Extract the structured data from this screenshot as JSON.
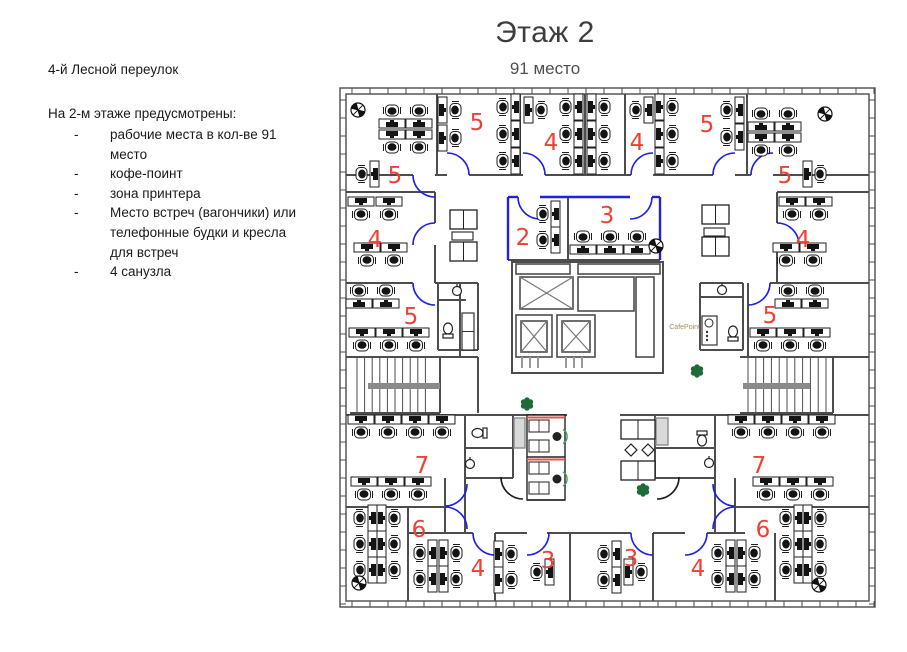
{
  "title": "Этаж 2",
  "subtitle": "91 место",
  "sidebar": {
    "address": "4-й Лесной переулок",
    "intro": "На 2-м этаже предусмотрены:",
    "bullets": [
      "рабочие места в кол-ве 91 место",
      "кофе-поинт",
      "зона принтера",
      "Место встреч (вагончики) или телефонные будки и кресла для встреч",
      "4 санузла"
    ]
  },
  "plan": {
    "colors": {
      "wall": "#4d4d4d",
      "door_blue": "#1f1fe8",
      "door_black": "#1a1a1a",
      "room_number": "#ee4035",
      "plant": "#1e6b38",
      "booth_red": "#e0584c",
      "booth_green": "#3fa45f",
      "gray_fill": "#d9d9d9",
      "landing": "#8a8a8a",
      "cafepoint_text": "#a38e55",
      "desk_stroke": "#1f1f1f",
      "desk_dark": "#141414"
    },
    "cafepoint_label": "CafePoint",
    "cafe": {
      "counter": [
        702,
        316,
        15,
        29
      ],
      "label_pos": [
        700,
        329
      ]
    },
    "envelope": [
      [
        340,
        88,
        535,
        519
      ],
      [
        346,
        94,
        523,
        507
      ]
    ],
    "mullion_spacing": 18,
    "room_numbers": [
      [
        "5",
        477,
        122
      ],
      [
        "4",
        551,
        142
      ],
      [
        "4",
        637,
        142
      ],
      [
        "5",
        707,
        124
      ],
      [
        "5",
        395,
        175
      ],
      [
        "5",
        785,
        175
      ],
      [
        "4",
        375,
        239
      ],
      [
        "4",
        803,
        239
      ],
      [
        "2",
        523,
        237
      ],
      [
        "3",
        607,
        215
      ],
      [
        "5",
        411,
        316
      ],
      [
        "5",
        770,
        315
      ],
      [
        "7",
        422,
        465
      ],
      [
        "7",
        759,
        465
      ],
      [
        "6",
        419,
        529
      ],
      [
        "6",
        763,
        529
      ],
      [
        "4",
        478,
        568
      ],
      [
        "3",
        548,
        560
      ],
      [
        "3",
        631,
        558
      ],
      [
        "4",
        698,
        568
      ]
    ],
    "walls": [
      [
        437,
        94,
        437,
        175
      ],
      [
        520,
        94,
        520,
        175
      ],
      [
        585,
        94,
        585,
        175
      ],
      [
        625,
        94,
        625,
        175
      ],
      [
        657,
        94,
        657,
        175
      ],
      [
        747,
        94,
        747,
        175
      ],
      [
        346,
        175,
        413,
        175
      ],
      [
        435,
        175,
        447,
        175
      ],
      [
        469,
        175,
        523,
        175
      ],
      [
        545,
        175,
        631,
        175
      ],
      [
        653,
        175,
        713,
        175
      ],
      [
        735,
        175,
        751,
        175
      ],
      [
        773,
        175,
        869,
        175
      ],
      [
        346,
        192,
        435,
        192
      ],
      [
        777,
        192,
        869,
        192
      ],
      [
        435,
        192,
        435,
        223
      ],
      [
        435,
        245,
        435,
        283
      ],
      [
        777,
        192,
        777,
        223
      ],
      [
        777,
        245,
        777,
        283
      ],
      [
        346,
        283,
        413,
        283
      ],
      [
        435,
        283,
        460,
        283
      ],
      [
        770,
        283,
        869,
        283
      ],
      [
        460,
        283,
        460,
        357
      ],
      [
        748,
        283,
        748,
        357
      ],
      [
        346,
        357,
        478,
        357
      ],
      [
        740,
        357,
        869,
        357
      ],
      [
        440,
        357,
        440,
        413
      ],
      [
        478,
        357,
        478,
        413
      ],
      [
        350,
        413,
        440,
        413
      ],
      [
        740,
        413,
        833,
        413
      ],
      [
        833,
        357,
        833,
        413
      ],
      [
        346,
        415,
        567,
        415
      ],
      [
        620,
        415,
        869,
        415
      ],
      [
        465,
        415,
        465,
        478
      ],
      [
        513,
        415,
        513,
        478
      ],
      [
        465,
        478,
        513,
        478
      ],
      [
        465,
        448,
        513,
        448
      ],
      [
        655,
        415,
        655,
        478
      ],
      [
        715,
        415,
        715,
        478
      ],
      [
        655,
        478,
        715,
        478
      ],
      [
        655,
        448,
        715,
        448
      ],
      [
        445,
        478,
        445,
        533
      ],
      [
        465,
        478,
        465,
        533
      ],
      [
        715,
        478,
        715,
        533
      ],
      [
        735,
        478,
        735,
        533
      ],
      [
        346,
        507,
        445,
        507
      ],
      [
        735,
        507,
        869,
        507
      ],
      [
        408,
        507,
        408,
        601
      ],
      [
        408,
        533,
        473,
        533
      ],
      [
        495,
        533,
        527,
        533
      ],
      [
        547,
        533,
        631,
        533
      ],
      [
        653,
        533,
        685,
        533
      ],
      [
        707,
        533,
        745,
        533
      ],
      [
        495,
        533,
        495,
        601
      ],
      [
        570,
        533,
        570,
        601
      ],
      [
        653,
        533,
        653,
        601
      ],
      [
        775,
        533,
        775,
        601
      ],
      [
        508,
        260,
        660,
        260
      ],
      [
        568,
        197,
        568,
        260
      ],
      [
        438,
        283,
        478,
        283
      ],
      [
        438,
        283,
        438,
        350
      ],
      [
        478,
        283,
        478,
        350
      ],
      [
        438,
        350,
        478,
        350
      ],
      [
        438,
        300,
        466,
        300
      ],
      [
        700,
        283,
        743,
        283
      ],
      [
        700,
        283,
        700,
        350
      ],
      [
        743,
        283,
        743,
        350
      ],
      [
        700,
        350,
        743,
        350
      ],
      [
        700,
        297,
        743,
        297
      ]
    ],
    "blue_walls": [
      [
        508,
        197,
        508,
        260
      ],
      [
        660,
        197,
        660,
        260
      ],
      [
        508,
        197,
        518,
        197
      ],
      [
        540,
        197,
        630,
        197
      ],
      [
        652,
        197,
        660,
        197
      ]
    ],
    "doors": [
      [
        447,
        175,
        270,
        360,
        "b"
      ],
      [
        523,
        175,
        270,
        360,
        "b"
      ],
      [
        653,
        175,
        270,
        180,
        "b"
      ],
      [
        735,
        175,
        270,
        180,
        "b"
      ],
      [
        435,
        175,
        90,
        180,
        "b"
      ],
      [
        773,
        175,
        270,
        180,
        "b"
      ],
      [
        435,
        245,
        270,
        180,
        "b"
      ],
      [
        777,
        245,
        270,
        360,
        "b"
      ],
      [
        435,
        283,
        90,
        180,
        "b"
      ],
      [
        748,
        283,
        90,
        0,
        "b"
      ],
      [
        540,
        197,
        90,
        180,
        "b"
      ],
      [
        630,
        197,
        90,
        0,
        "b"
      ],
      [
        445,
        484,
        0,
        90,
        "b"
      ],
      [
        445,
        529,
        270,
        360,
        "b"
      ],
      [
        735,
        484,
        90,
        180,
        "b"
      ],
      [
        735,
        529,
        180,
        270,
        "b"
      ],
      [
        495,
        533,
        90,
        180,
        "b"
      ],
      [
        527,
        533,
        0,
        90,
        "b"
      ],
      [
        653,
        533,
        90,
        180,
        "b"
      ],
      [
        685,
        533,
        0,
        90,
        "b"
      ],
      [
        523,
        477,
        90,
        180,
        "k"
      ],
      [
        657,
        477,
        0,
        90,
        "k"
      ]
    ],
    "desks": [
      [
        392,
        115,
        180
      ],
      [
        419,
        115,
        180
      ],
      [
        392,
        143,
        0
      ],
      [
        419,
        143,
        0
      ],
      [
        366,
        174,
        90
      ],
      [
        451,
        110,
        270
      ],
      [
        451,
        138,
        270
      ],
      [
        507,
        107,
        90
      ],
      [
        507,
        134,
        90
      ],
      [
        507,
        161,
        90
      ],
      [
        537,
        110,
        270
      ],
      [
        570,
        107,
        90
      ],
      [
        570,
        134,
        90
      ],
      [
        570,
        161,
        90
      ],
      [
        600,
        107,
        270
      ],
      [
        600,
        134,
        270
      ],
      [
        600,
        161,
        270
      ],
      [
        640,
        110,
        90
      ],
      [
        668,
        107,
        270
      ],
      [
        668,
        134,
        270
      ],
      [
        668,
        161,
        270
      ],
      [
        731,
        110,
        90
      ],
      [
        731,
        137,
        90
      ],
      [
        761,
        118,
        180
      ],
      [
        788,
        118,
        180
      ],
      [
        761,
        146,
        0
      ],
      [
        788,
        146,
        0
      ],
      [
        816,
        174,
        270
      ],
      [
        361,
        210,
        0
      ],
      [
        389,
        210,
        0
      ],
      [
        367,
        256,
        0
      ],
      [
        394,
        256,
        0
      ],
      [
        792,
        210,
        0
      ],
      [
        819,
        210,
        0
      ],
      [
        786,
        256,
        0
      ],
      [
        813,
        256,
        0
      ],
      [
        359,
        295,
        180
      ],
      [
        386,
        295,
        180
      ],
      [
        362,
        341,
        0
      ],
      [
        389,
        341,
        0
      ],
      [
        416,
        341,
        0
      ],
      [
        788,
        295,
        180
      ],
      [
        815,
        295,
        180
      ],
      [
        763,
        341,
        0
      ],
      [
        790,
        341,
        0
      ],
      [
        817,
        341,
        0
      ],
      [
        547,
        214,
        90
      ],
      [
        547,
        240,
        90
      ],
      [
        583,
        241,
        180
      ],
      [
        610,
        241,
        180
      ],
      [
        637,
        241,
        180
      ],
      [
        361,
        428,
        0
      ],
      [
        388,
        428,
        0
      ],
      [
        415,
        428,
        0
      ],
      [
        442,
        428,
        0
      ],
      [
        364,
        490,
        0
      ],
      [
        391,
        490,
        0
      ],
      [
        418,
        490,
        0
      ],
      [
        741,
        428,
        0
      ],
      [
        768,
        428,
        0
      ],
      [
        795,
        428,
        0
      ],
      [
        822,
        428,
        0
      ],
      [
        766,
        490,
        0
      ],
      [
        793,
        490,
        0
      ],
      [
        820,
        490,
        0
      ],
      [
        364,
        518,
        90
      ],
      [
        390,
        518,
        270
      ],
      [
        364,
        544,
        90
      ],
      [
        390,
        544,
        270
      ],
      [
        364,
        570,
        90
      ],
      [
        390,
        570,
        270
      ],
      [
        790,
        518,
        90
      ],
      [
        816,
        518,
        270
      ],
      [
        790,
        544,
        90
      ],
      [
        816,
        544,
        270
      ],
      [
        790,
        570,
        90
      ],
      [
        816,
        570,
        270
      ],
      [
        424,
        553,
        90
      ],
      [
        424,
        579,
        90
      ],
      [
        452,
        553,
        270
      ],
      [
        452,
        579,
        270
      ],
      [
        507,
        554,
        270
      ],
      [
        507,
        580,
        270
      ],
      [
        541,
        572,
        90
      ],
      [
        608,
        554,
        90
      ],
      [
        608,
        580,
        90
      ],
      [
        637,
        572,
        270
      ],
      [
        722,
        553,
        90
      ],
      [
        722,
        579,
        90
      ],
      [
        750,
        553,
        270
      ],
      [
        750,
        579,
        270
      ]
    ],
    "stairs": [
      {
        "x1": 357,
        "x2": 433,
        "y1": 357,
        "y2": 413,
        "step": 7.6,
        "bar": [
          368,
          383,
          72,
          6
        ]
      },
      {
        "x1": 748,
        "x2": 826,
        "y1": 357,
        "y2": 413,
        "step": 7.8,
        "bar": [
          743,
          383,
          67,
          6
        ]
      }
    ],
    "core": {
      "outline": [
        512,
        262,
        151,
        111
      ],
      "plain_rects": [
        [
          516,
          264,
          54,
          10
        ],
        [
          578,
          264,
          82,
          10
        ],
        [
          578,
          277,
          56,
          34
        ],
        [
          516,
          315,
          36,
          42
        ],
        [
          557,
          315,
          38,
          42
        ],
        [
          636,
          277,
          18,
          80
        ]
      ],
      "x_rects": [
        [
          520,
          277,
          53,
          32
        ],
        [
          521,
          321,
          26,
          31
        ],
        [
          562,
          321,
          28,
          31
        ]
      ],
      "gray_ticks": [
        [
          522,
          357,
          522,
          368
        ],
        [
          530,
          357,
          530,
          368
        ],
        [
          538,
          357,
          538,
          368
        ],
        [
          566,
          357,
          566,
          368
        ],
        [
          574,
          357,
          574,
          368
        ],
        [
          582,
          357,
          582,
          368
        ]
      ]
    },
    "toilets": [
      [
        448,
        331,
        0
      ],
      [
        733,
        334,
        0
      ],
      [
        480,
        433,
        270
      ],
      [
        702,
        438,
        180
      ]
    ],
    "sinks": [
      [
        457,
        291
      ],
      [
        722,
        290
      ],
      [
        470,
        464
      ],
      [
        709,
        463
      ]
    ],
    "gray_rects": [
      [
        514,
        418,
        11,
        30
      ],
      [
        656,
        418,
        12,
        27
      ]
    ],
    "cabinets": [
      [
        462,
        313,
        12,
        37
      ]
    ],
    "sofa_groups": [
      {
        "rects": [
          [
            450,
            210,
            27,
            19
          ],
          [
            450,
            242,
            27,
            19
          ]
        ],
        "tables": [
          [
            452,
            232,
            21,
            8
          ]
        ],
        "diamonds": []
      },
      {
        "rects": [
          [
            702,
            205,
            27,
            19
          ],
          [
            702,
            237,
            27,
            19
          ]
        ],
        "tables": [
          [
            704,
            228,
            21,
            8
          ]
        ],
        "diamonds": []
      },
      {
        "rects": [
          [
            621,
            420,
            34,
            19
          ],
          [
            621,
            461,
            34,
            19
          ]
        ],
        "tables": [],
        "diamonds": [
          [
            631,
            450
          ],
          [
            648,
            450
          ]
        ]
      }
    ],
    "booths": {
      "x": 527,
      "y": 415,
      "w": 38,
      "halves": [
        [
          416,
          457
        ],
        [
          458,
          500
        ]
      ]
    },
    "plants": [
      [
        527,
        404
      ],
      [
        697,
        371
      ],
      [
        643,
        490
      ]
    ],
    "columns": [
      [
        358,
        110
      ],
      [
        825,
        114
      ],
      [
        656,
        246
      ],
      [
        359,
        583
      ],
      [
        819,
        585
      ]
    ]
  }
}
